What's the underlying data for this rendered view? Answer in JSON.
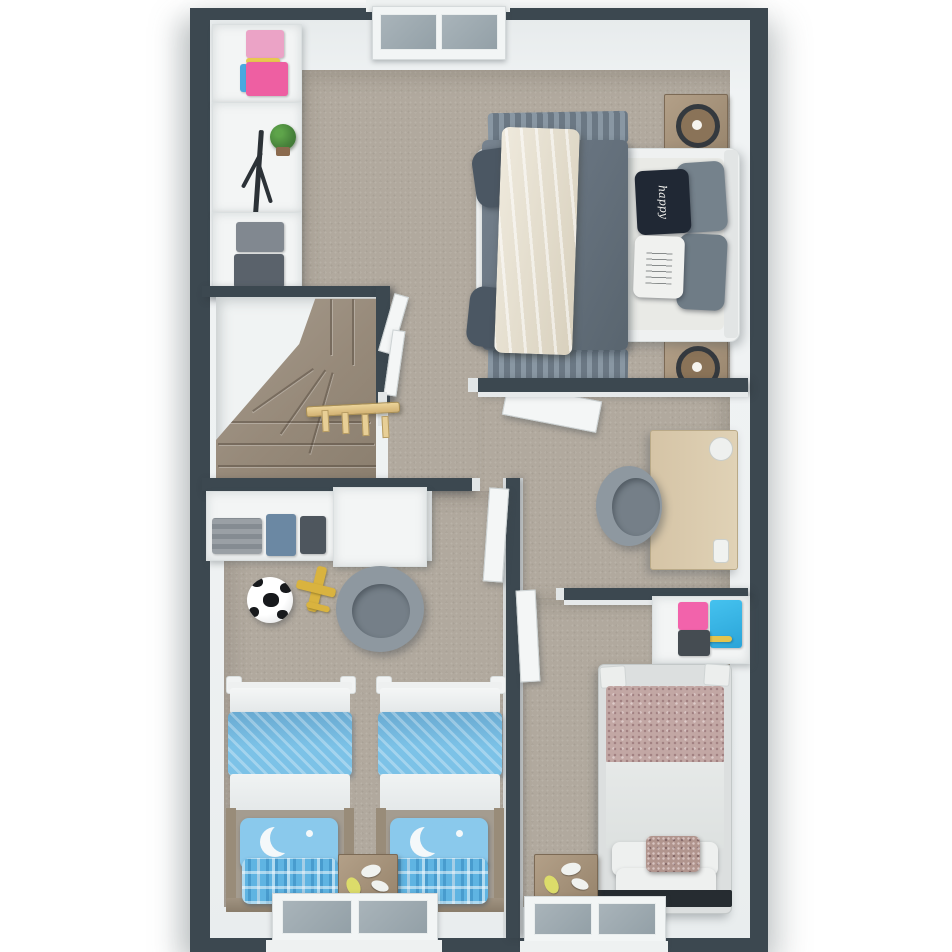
{
  "scene": {
    "type": "3d-floorplan-top-down-render",
    "storey": "upper-floor",
    "palette": {
      "wall_dark": "#3c4850",
      "wall_white": "#eef1f2",
      "carpet": "#b1a99e",
      "stair_carpet": "#988b7b",
      "railing_wood": "#e0c083",
      "nightstand_wood": "#a08a6f",
      "desk_wood": "#dacaad",
      "master_duvet_gray": "#67737f",
      "master_throw_cream": "#e9e4d6",
      "pillow_navy": "#202834",
      "kids_duvet_blue": "#7cc2e7",
      "kids_pillow_blue": "#8ac9ec",
      "single_blanket_mauve": "#c2a7a4",
      "accent_pink": "#ee5fa2",
      "accent_cyan": "#3cb9ea",
      "accent_yellow": "#dcdc6a",
      "window_glass": "#9aa6ad",
      "office_chair_gray": "#8e98a0"
    },
    "windows": [
      {
        "id": "top-window",
        "wall": "north",
        "panes": 2
      },
      {
        "id": "bottom-window-kids",
        "wall": "south",
        "panes": 2
      },
      {
        "id": "bottom-window-single",
        "wall": "south",
        "panes": 2
      }
    ],
    "rooms": [
      {
        "id": "master-bedroom",
        "position": "top",
        "furniture": [
          "double-bed",
          "gray-duvet",
          "cream-throw-blanket",
          "navy-script-pillow",
          "white-text-pillow",
          "two-gray-pillows",
          "nightstand-with-lamp-north",
          "nightstand-with-lamp-south",
          "closet-shelf-pink-clothes",
          "coat-rack",
          "potted-plant",
          "closet-shelf-gray-clothes",
          "door-to-hallway"
        ]
      },
      {
        "id": "staircase",
        "position": "middle-left",
        "furniture": [
          "winder-stairs",
          "wood-railing-with-balusters",
          "stair-door"
        ]
      },
      {
        "id": "hallway-study",
        "position": "middle-right",
        "furniture": [
          "desk",
          "office-chair",
          "desk-cup",
          "desk-accessory"
        ]
      },
      {
        "id": "kids-bedroom",
        "position": "bottom-left",
        "furniture": [
          "storage-shelf-clothes",
          "wardrobe",
          "soccer-ball",
          "toy-plane",
          "tub-chair",
          "twin-bed-left",
          "twin-bed-right",
          "shared-nightstand",
          "door"
        ]
      },
      {
        "id": "single-bedroom",
        "position": "bottom-right",
        "furniture": [
          "wall-shelf-clothes",
          "single-bed",
          "floral-pillow",
          "nightstand",
          "door"
        ]
      }
    ],
    "decor_text": {
      "master_pillow_script": "happy"
    }
  }
}
